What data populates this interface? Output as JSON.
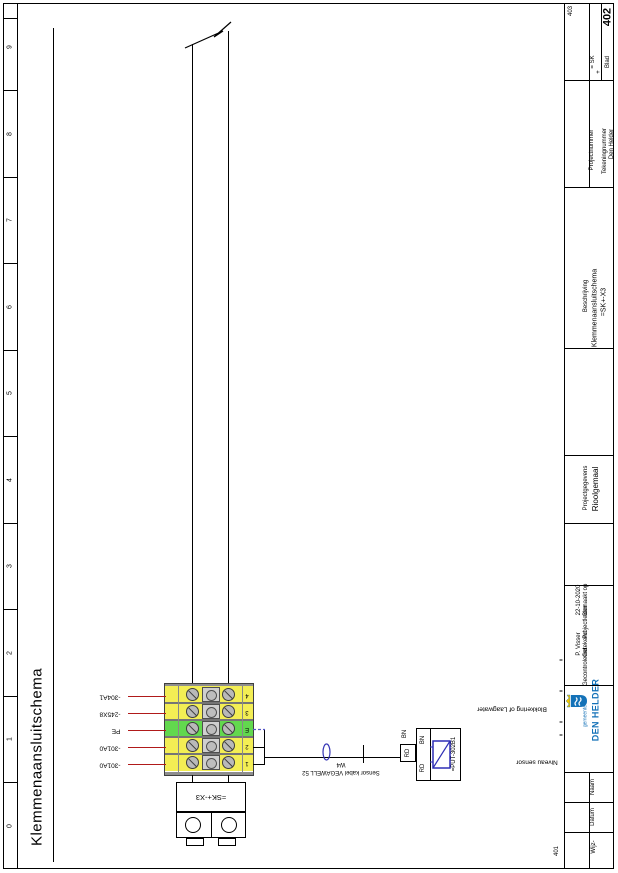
{
  "page": {
    "sheet_title": "Klemmenaansluitschema",
    "ruler_numbers": [
      "9",
      "8",
      "7",
      "6",
      "5",
      "4",
      "3",
      "2",
      "1",
      "0"
    ],
    "nav_next": "403",
    "nav_prev": "401"
  },
  "schematic": {
    "terminal_block": {
      "tag": "=SK+-X3",
      "terminals": [
        {
          "number": "4",
          "wire": "-304A1"
        },
        {
          "number": "3",
          "wire": "-245X8"
        },
        {
          "number": "E",
          "wire": "PE"
        },
        {
          "number": "2",
          "wire": "-301A0"
        },
        {
          "number": "1",
          "wire": "-301A0"
        }
      ]
    },
    "cable": {
      "name": "W4",
      "description": "Sensor kabel VEGAWELL 52"
    },
    "sensor": {
      "tag": "=PUT-302B1",
      "terminal_top": "BN",
      "terminal_bottom": "RD",
      "inner_top": "BN",
      "inner_bottom": "RD"
    },
    "annotations": {
      "blokkering": "Blokkering of Laagwater",
      "niveau": "Niveau sensor"
    },
    "ref_marks": [
      "=",
      "=",
      "=",
      "="
    ],
    "colors": {
      "terminal_yellow": "#f3ee54",
      "terminal_green": "#62d84e",
      "wire_label_red": "#b01a1a",
      "symbol_blue": "#3333b8"
    }
  },
  "title_block": {
    "eq_value": "= SK",
    "plus_value": "+",
    "blad_label": "Blad",
    "blad_value": "402",
    "projectnummer_label": "Projectnummer",
    "tekeningnummer_label": "Tekeningnummer",
    "tekeningnummer_value": "Den Helder",
    "beschrijving_label": "Beschrijving",
    "beschrijving_line1": "Klemmenaansluitschema",
    "beschrijving_line2": "=SK+-X3",
    "projectgegevens_label": "Projectgegevens",
    "projectgegevens_value": "Rioolgemaal",
    "fields": [
      {
        "label": "Gemaakt op",
        "value": "22-10-2020"
      },
      {
        "label": "Projectleider",
        "value": ""
      },
      {
        "label": "Getekend",
        "value": "P. Visser"
      },
      {
        "label": "Gecontroleerd",
        "value": ""
      }
    ],
    "logo": {
      "small": "gemeente",
      "large": "DEN HELDER",
      "color": "#1472b8"
    },
    "revision": {
      "naam": "Naam",
      "datum": "Datum",
      "wijz": "Wijz-"
    }
  }
}
